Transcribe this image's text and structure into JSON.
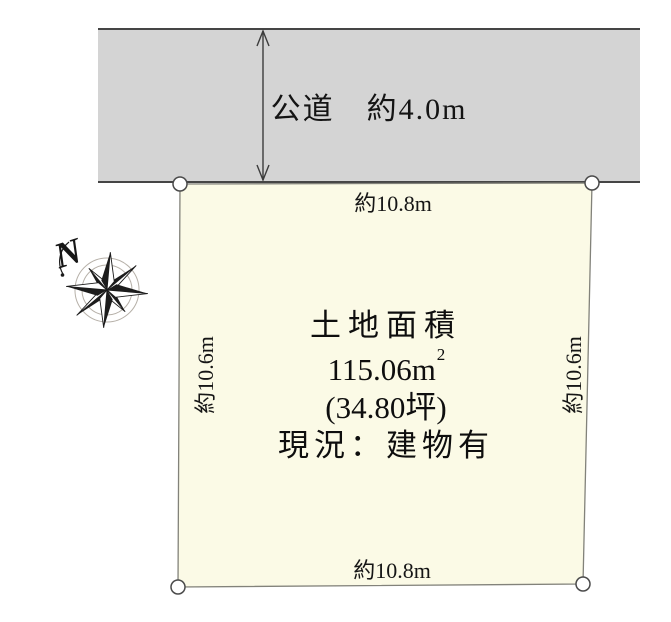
{
  "diagram": {
    "background": "#ffffff",
    "line_color": "#454545"
  },
  "road": {
    "label": "公道　約4.0m",
    "fill": "#d4d4d4"
  },
  "plot": {
    "fill": "#fbfae6",
    "area_title": "土地面積",
    "area_value": "115.06",
    "area_unit_base": "m",
    "area_unit_sup": "2",
    "area_tsubo": "(34.80坪)",
    "status": "現況：建物有"
  },
  "dimensions": {
    "top": "約10.8m",
    "bottom": "約10.8m",
    "left": "約10.6m",
    "right": "約10.6m"
  },
  "compass": {
    "north_label": "N"
  }
}
